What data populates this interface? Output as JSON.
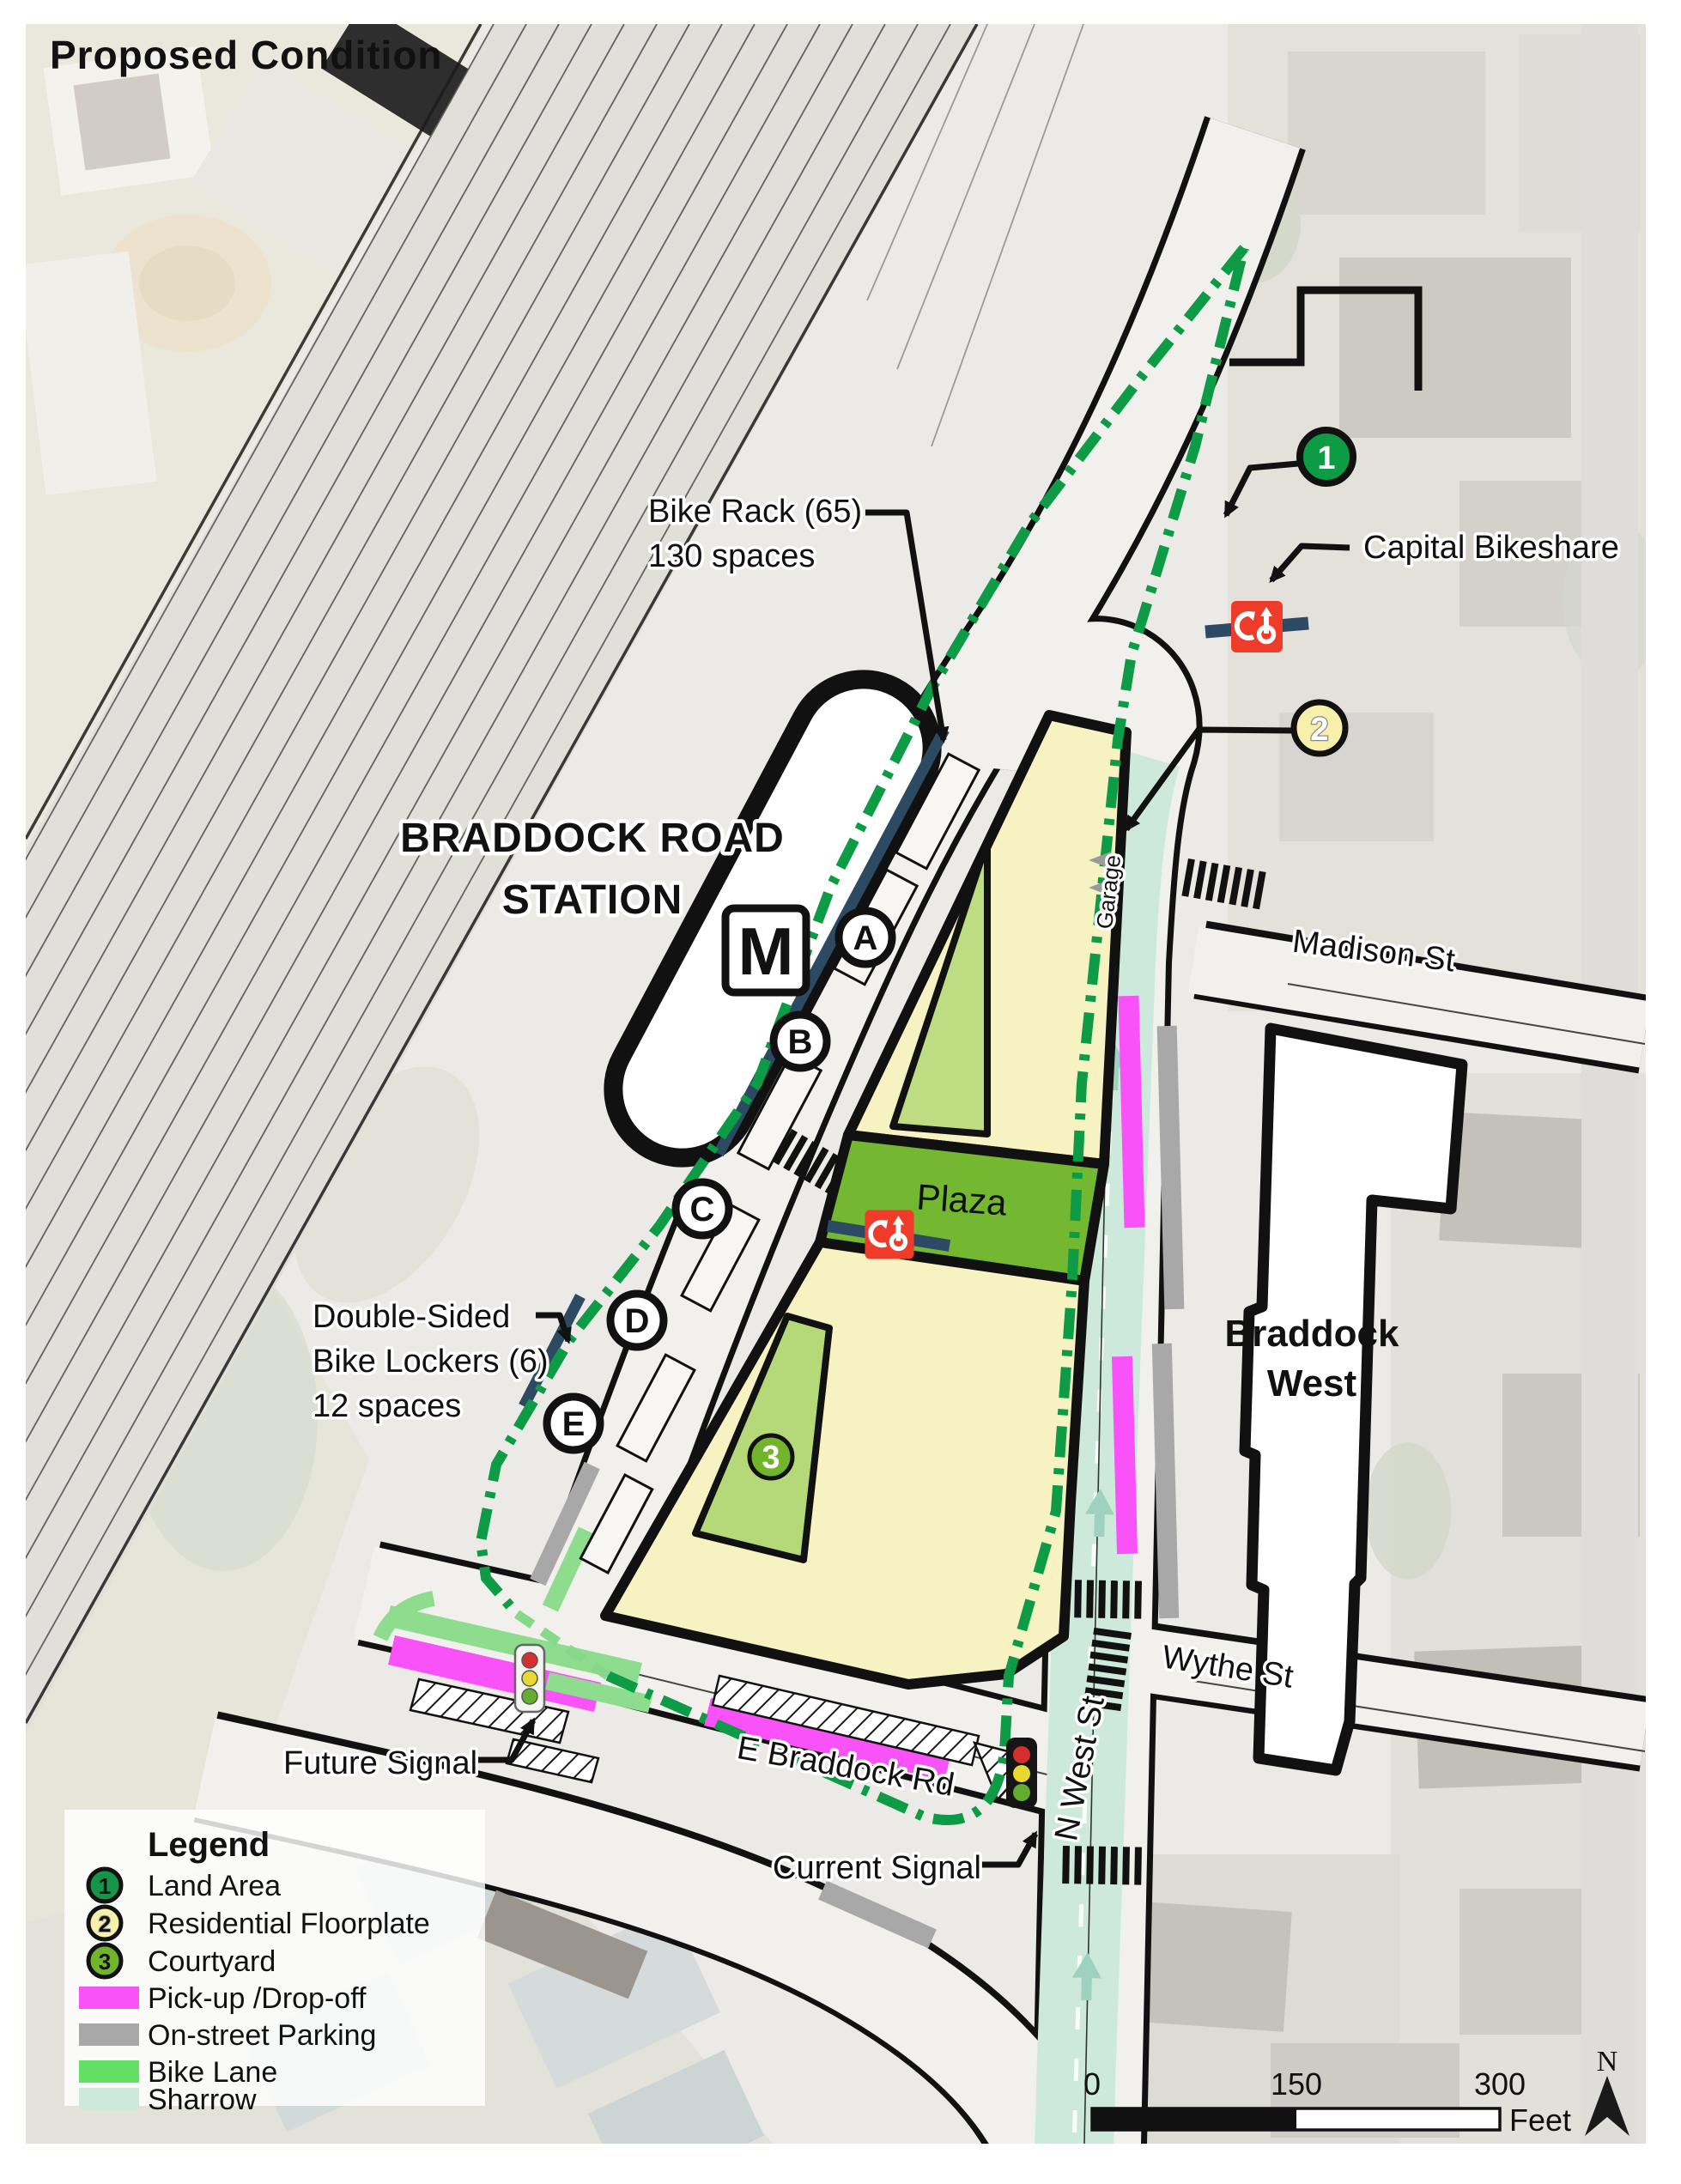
{
  "title": "Proposed Condition",
  "map": {
    "station_line1": "BRADDOCK ROAD",
    "station_line2": "STATION",
    "metro_m": "M",
    "bays": {
      "a": "A",
      "b": "B",
      "c": "C",
      "d": "D",
      "e": "E"
    },
    "markers": {
      "m1": "1",
      "m2": "2",
      "m3": "3"
    },
    "labels": {
      "bike_rack_l1": "Bike Rack (65)",
      "bike_rack_l2": "130 spaces",
      "capital_bikeshare": "Capital Bikeshare",
      "lockers_l1": "Double-Sided",
      "lockers_l2": "Bike Lockers (6)",
      "lockers_l3": "12 spaces",
      "plaza": "Plaza",
      "braddock_west_l1": "Braddock",
      "braddock_west_l2": "West",
      "garage": "Garage",
      "future_signal": "Future Signal",
      "current_signal": "Current Signal"
    },
    "streets": {
      "madison": "Madison St",
      "wythe": "Wythe St",
      "n_west": "N West St",
      "e_braddock": "E Braddock Rd"
    }
  },
  "legend": {
    "title": "Legend",
    "items": [
      {
        "type": "circle",
        "number": "1",
        "color": "#18944a",
        "label": "Land Area"
      },
      {
        "type": "circle",
        "number": "2",
        "color": "#f6f0aa",
        "label": "Residential Floorplate"
      },
      {
        "type": "circle",
        "number": "3",
        "color": "#72b42c",
        "label": "Courtyard"
      },
      {
        "type": "swatch",
        "color": "#f952f9",
        "label": "Pick-up /Drop-off"
      },
      {
        "type": "swatch",
        "color": "#a8a8a8",
        "label": "On-street Parking"
      },
      {
        "type": "swatch",
        "color": "#63e063",
        "label": "Bike Lane"
      },
      {
        "type": "swatch",
        "color": "#cde9dc",
        "label": "Sharrow"
      }
    ]
  },
  "scalebar": {
    "t0": "0",
    "t150": "150",
    "t300": "300",
    "unit": "Feet"
  },
  "north_label": "N",
  "colors": {
    "land_area_green": "#0d9b45",
    "residential_yellow": "#f6f2c2",
    "courtyard_green": "#bedc82",
    "courtyard_green2": "#b5d878",
    "courtyard_marker_green": "#72b42c",
    "plaza_green": "#74b730",
    "pickup_magenta": "#f952f9",
    "parking_gray": "#a8a8a8",
    "bike_lane_green": "#8edc8e",
    "sharrow_mint": "#cde9dc",
    "bikeshare_red": "#ee3b2a",
    "rack_navy": "#2d4a63"
  }
}
